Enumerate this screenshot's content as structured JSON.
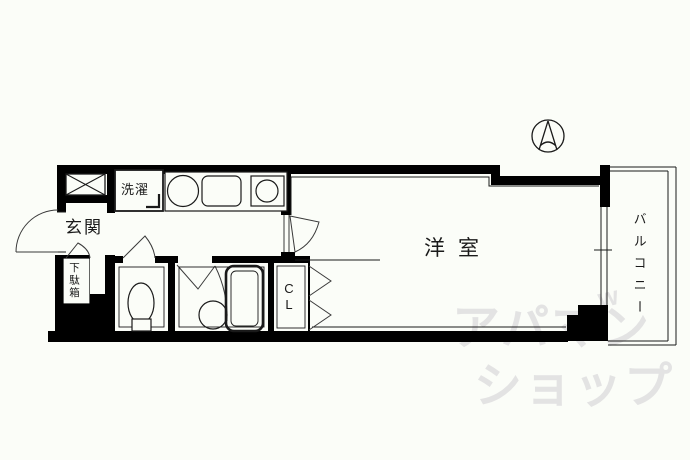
{
  "floorplan": {
    "rooms": {
      "entrance": "玄関",
      "laundry": "洗濯",
      "shoe_cabinet": "下駄箱",
      "western_room": "洋室",
      "closet_line1": "C",
      "closet_line2": "L",
      "balcony": "バルコニー"
    },
    "watermark": {
      "line1": "アパマン",
      "line2": "ショップ",
      "mark": "w"
    },
    "icons": {
      "compass": "north-arrow"
    },
    "colors": {
      "wall": "#000000",
      "background": "#fbfdf8",
      "watermark": "#e3e3e3"
    }
  }
}
